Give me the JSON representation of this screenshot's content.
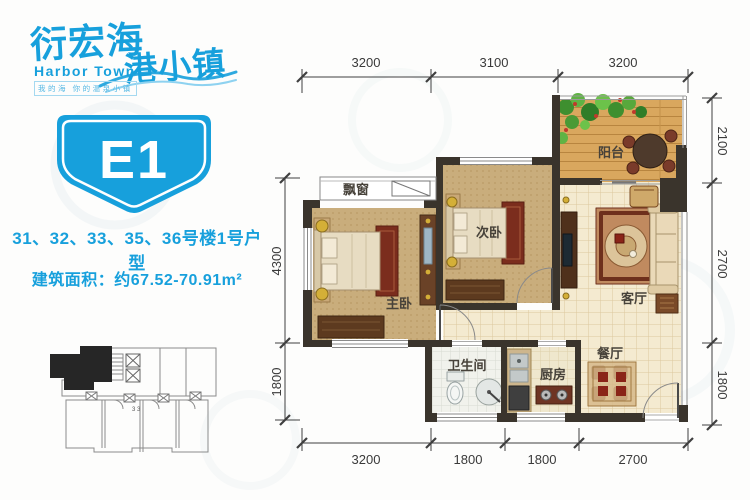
{
  "brand": {
    "name_part1": "衍宏海",
    "name_part2": "港小镇",
    "name_en": "Harbor Town",
    "tagline": "我的海 你的温泉小镇",
    "accent_color": "#17a0dc"
  },
  "unit": {
    "code": "E1",
    "buildings_line": "31、32、33、35、36号楼1号户型",
    "area_line": "建筑面积：约67.52-70.91m²"
  },
  "rooms": {
    "balcony": "阳台",
    "bedroom2": "次卧",
    "master": "主卧",
    "living": "客厅",
    "dining": "餐厅",
    "kitchen": "厨房",
    "bathroom": "卫生间",
    "baywindow": "飘窗"
  },
  "dimensions": {
    "top": [
      "3200",
      "3100",
      "3200"
    ],
    "bottom": [
      "3200",
      "1800",
      "1800",
      "2700"
    ],
    "right": [
      "2100",
      "2700",
      "1800"
    ],
    "left": [
      "4300",
      "1800"
    ]
  },
  "keyplan": {
    "note": "3 3"
  }
}
